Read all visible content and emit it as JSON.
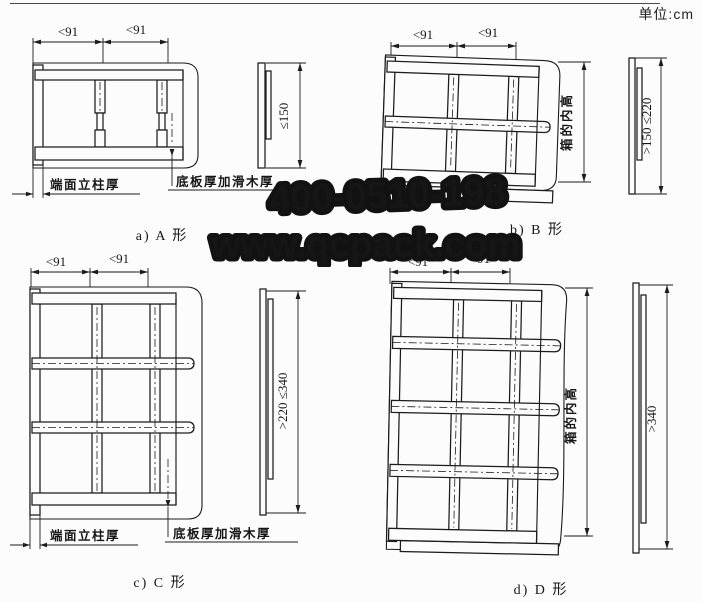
{
  "page": {
    "unit_label": "单位:cm"
  },
  "watermark": {
    "phone": "400-0510-198",
    "website": "www.qcpack.com"
  },
  "figures": [
    {
      "type": "A",
      "caption": "a) A 形",
      "dim1": "<91",
      "dim2": "<91",
      "side_dim": "≤150",
      "post_label": "端面立柱厚",
      "bottom_label": "底板厚加滑木厚"
    },
    {
      "type": "B",
      "caption": "b) B 形",
      "dim1": "<91",
      "dim2": "<91",
      "side_dim": ">150 ≤220",
      "height_label": "箱的内高"
    },
    {
      "type": "C",
      "caption": "c) C 形",
      "dim1": "<91",
      "dim2": "<91",
      "side_dim": ">220 ≤340",
      "post_label": "端面立柱厚",
      "bottom_label": "底板厚加滑木厚"
    },
    {
      "type": "D",
      "caption": "d) D 形",
      "dim1": "<91",
      "dim2": "<91",
      "side_dim": ">340",
      "height_label": "箱的内高"
    }
  ],
  "colors": {
    "line": "#1c1c1c",
    "background": "#fcfcfc",
    "watermark_fill": "#9e9e9e",
    "watermark_stroke": "#121212"
  }
}
